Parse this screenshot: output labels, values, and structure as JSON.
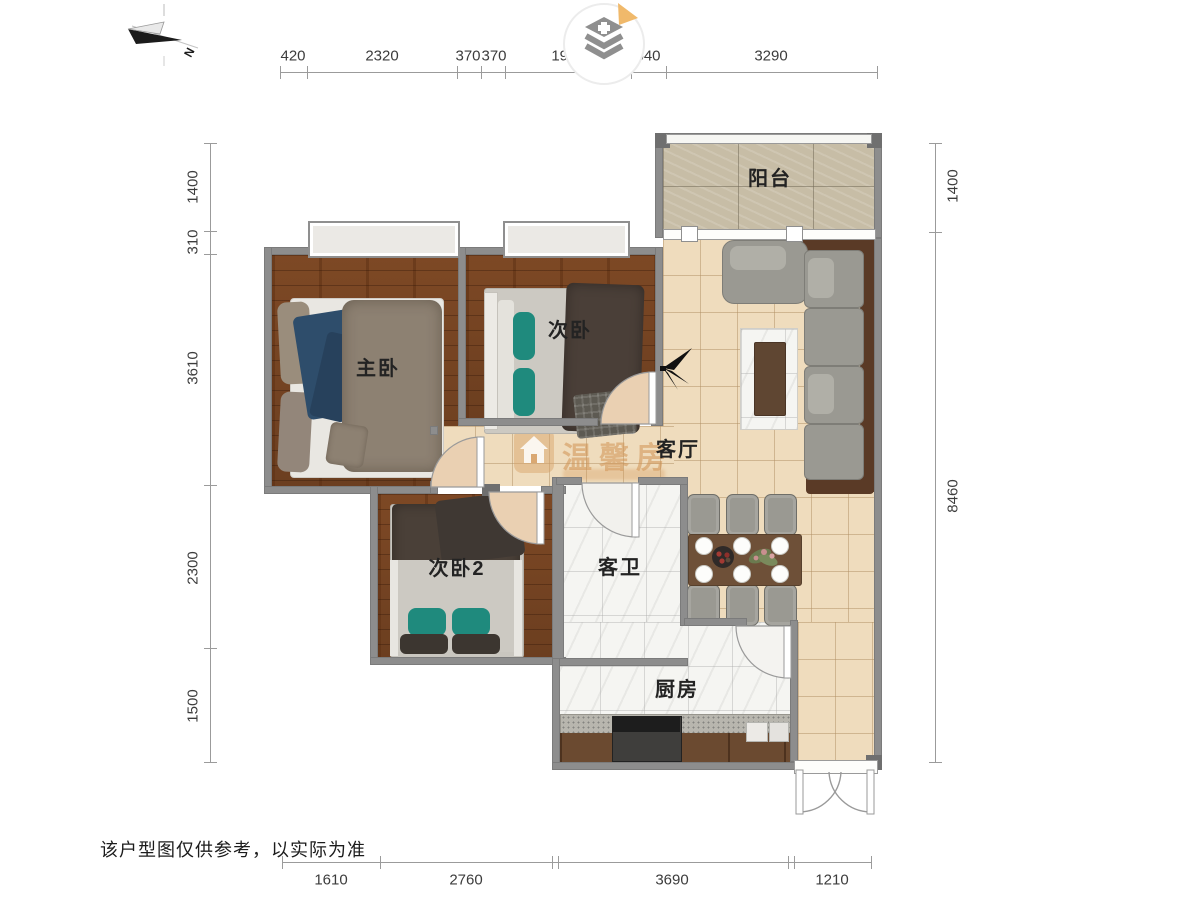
{
  "compass": {
    "label": "N"
  },
  "watermark": {
    "text": "温馨房"
  },
  "notes": {
    "disclaimer": "该户型图仅供参考，以实际为准"
  },
  "rooms": {
    "balcony": {
      "label": "阳台"
    },
    "master": {
      "label": "主卧"
    },
    "bedroom2": {
      "label": "次卧"
    },
    "bedroom3": {
      "label": "次卧2"
    },
    "living": {
      "label": "客厅"
    },
    "bath": {
      "label": "客卫"
    },
    "kitchen": {
      "label": "厨房"
    }
  },
  "dimensions": {
    "top": [
      "420",
      "2320",
      "370",
      "370",
      "1950",
      "540",
      "3290"
    ],
    "left": [
      "1400",
      "310",
      "3610",
      "2300",
      "1500"
    ],
    "right": [
      "1400",
      "8460"
    ],
    "bottom": [
      "1610",
      "2760",
      "3690",
      "1210"
    ]
  },
  "colors": {
    "wall": "#8d8d8d",
    "wood_floor": "#7c4a27",
    "tile_floor": "#efdcbd",
    "balcony_floor": "#c7bda6",
    "marble_floor": "#f5f5f2",
    "watermark": "#d09252",
    "sofa_frame": "#5a3a26",
    "accent_teal": "#1f8a7d",
    "layer_badge": "#f0b96b"
  }
}
